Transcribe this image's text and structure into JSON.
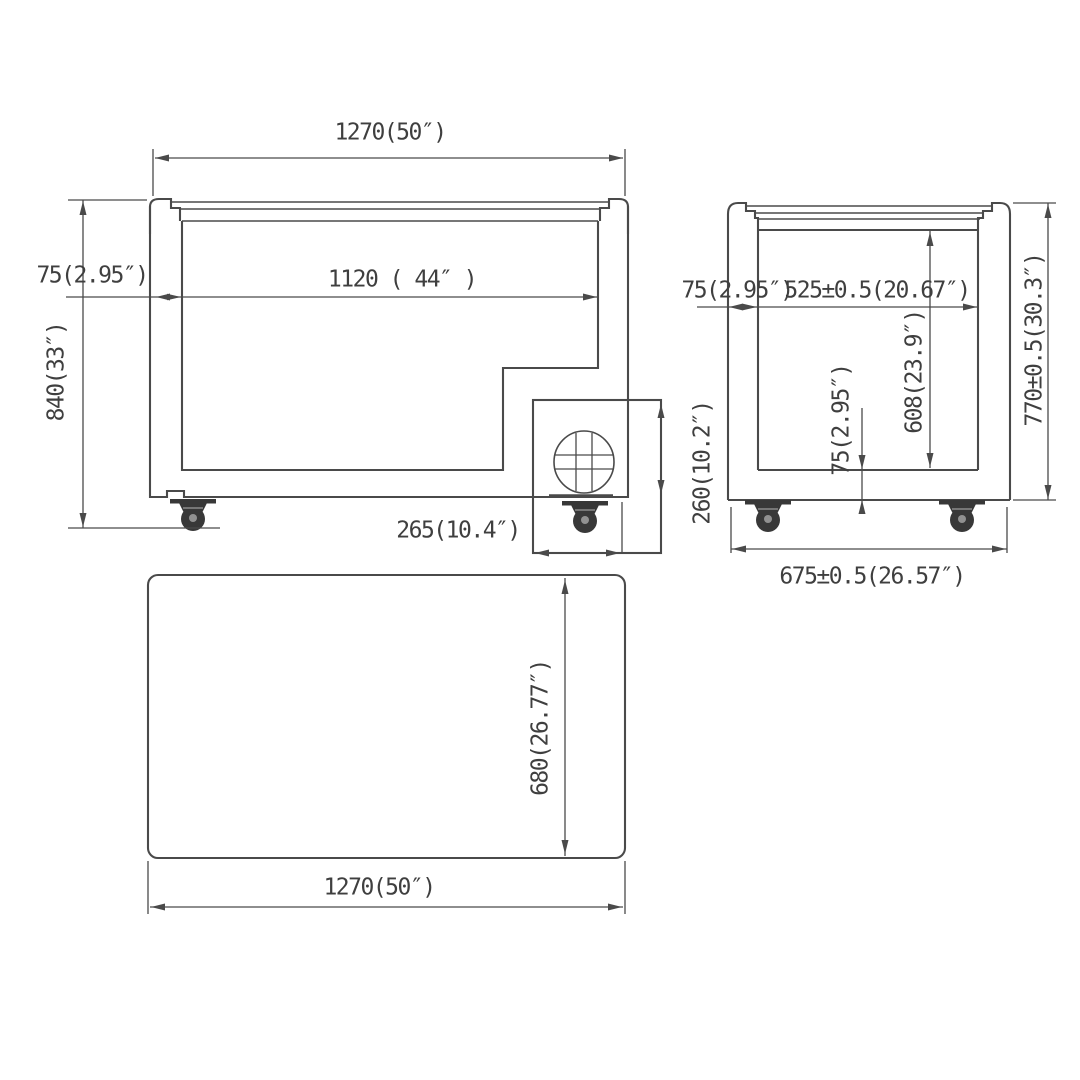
{
  "drawing": {
    "type": "chest-freezer dimensional drawing (front, side, top views)",
    "colors": {
      "background": "#ffffff",
      "line": "#4a4a4a",
      "text": "#3f3f3f"
    },
    "dims": {
      "front_overall_width": "1270(50″)",
      "front_wall_thickness": "75(2.95″)",
      "front_overall_height": "840(33″)",
      "front_interior_width": "1120 ( 44″ )",
      "compressor_width": "265(10.4″)",
      "compressor_height": "260(10.2″)",
      "side_wall_thickness": "75(2.95″)",
      "side_interior_depth": "525±0.5(20.67″)",
      "side_overall_height": "770±0.5(30.3″)",
      "side_interior_height": "608(23.9″)",
      "side_bottom_thickness": "75(2.95″)",
      "side_overall_depth": "675±0.5(26.57″)",
      "top_depth": "680(26.77″)",
      "top_width": "1270(50″)"
    }
  }
}
